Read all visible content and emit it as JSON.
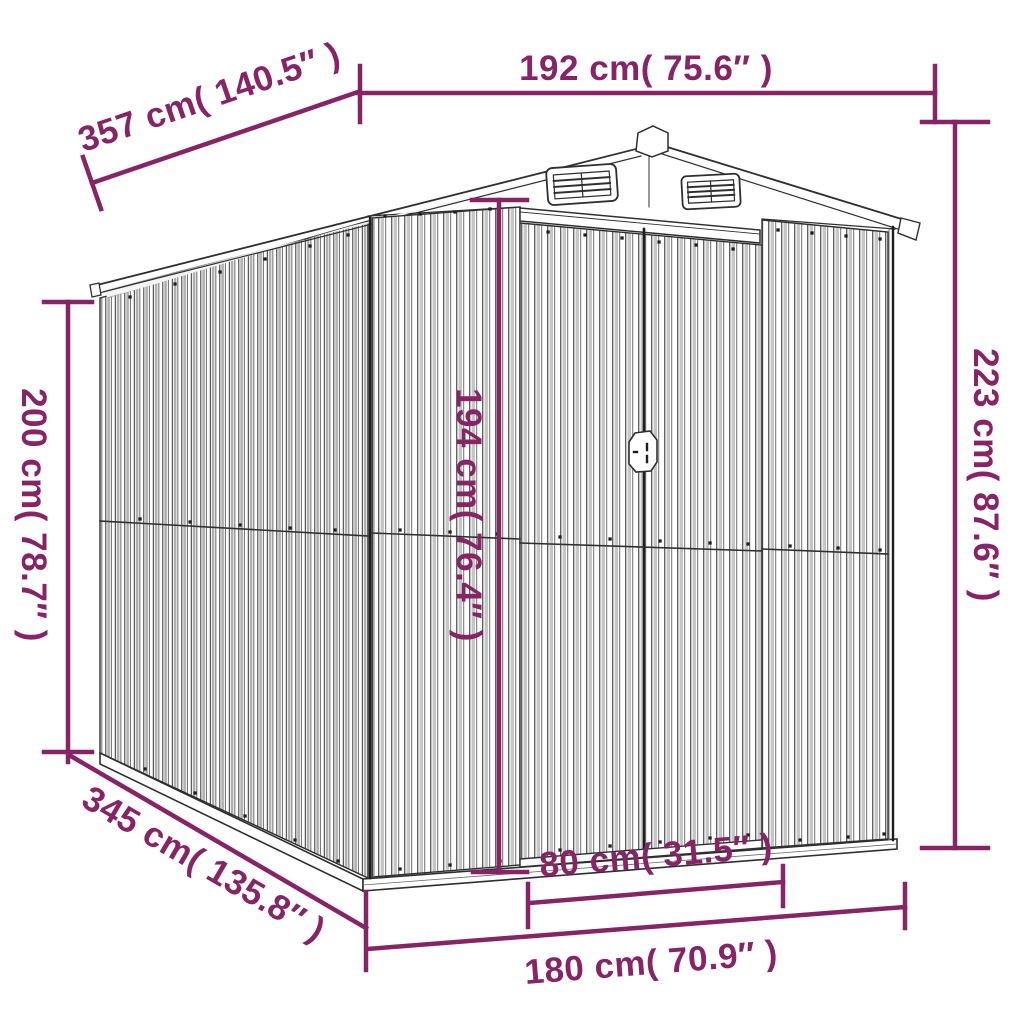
{
  "diagram": {
    "name": "garden-shed-dimension-diagram",
    "accent_color": "#862465",
    "line_color": "#2f2f2f",
    "dimensions": {
      "top_width": "192 cm( 75.6″ )",
      "roof_depth": "357 cm( 140.5″ )",
      "left_height": "200 cm( 78.7″ )",
      "right_height": "223 cm( 87.6″ )",
      "door_height": "194 cm( 76.4″ )",
      "base_depth": "345 cm( 135.8″ )",
      "door_width": "80 cm( 31.5″ )",
      "front_width": "180 cm( 70.9″ )"
    }
  }
}
